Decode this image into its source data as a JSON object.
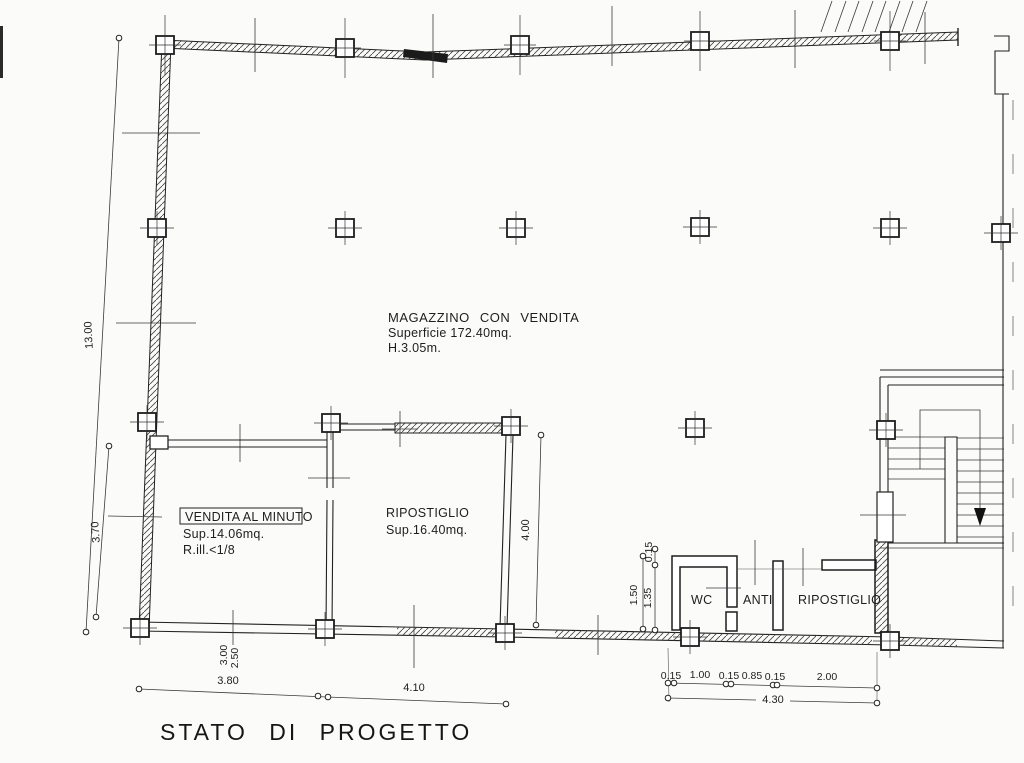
{
  "title": "STATO DI PROGETTO",
  "rooms": {
    "magazzino": {
      "name": "MAGAZZINO CON VENDITA",
      "surface": "Superficie 172.40mq.",
      "height": "H.3.05m."
    },
    "vendita": {
      "name": "VENDITA AL MINUTO",
      "surface": "Sup.14.06mq.",
      "illumination": "R.ill.<1/8"
    },
    "ripostiglio_centro": {
      "name": "RIPOSTIGLIO",
      "surface": "Sup.16.40mq."
    },
    "wc": {
      "name": "WC"
    },
    "anti": {
      "name": "ANTI"
    },
    "ripostiglio_destra": {
      "name": "RIPOSTIGLIO"
    }
  },
  "dims": {
    "left_total": "13.00",
    "left_lower": "3.70",
    "storage_height": "4.00",
    "wc_offset": "0.15",
    "wc_outer": "1.50",
    "wc_inner": "1.35",
    "bottom_a": "3.80",
    "bottom_b": "4.10",
    "bottom_v1": "3.00",
    "bottom_v2": "2.50",
    "seg_1": "0.15",
    "seg_2": "1.00",
    "seg_3": "0.15",
    "seg_4": "0.85",
    "seg_5": "0.15",
    "seg_6": "2.00",
    "seg_total": "4.30"
  },
  "colors": {
    "ink": "#222222",
    "paper": "#fbfbf9"
  }
}
